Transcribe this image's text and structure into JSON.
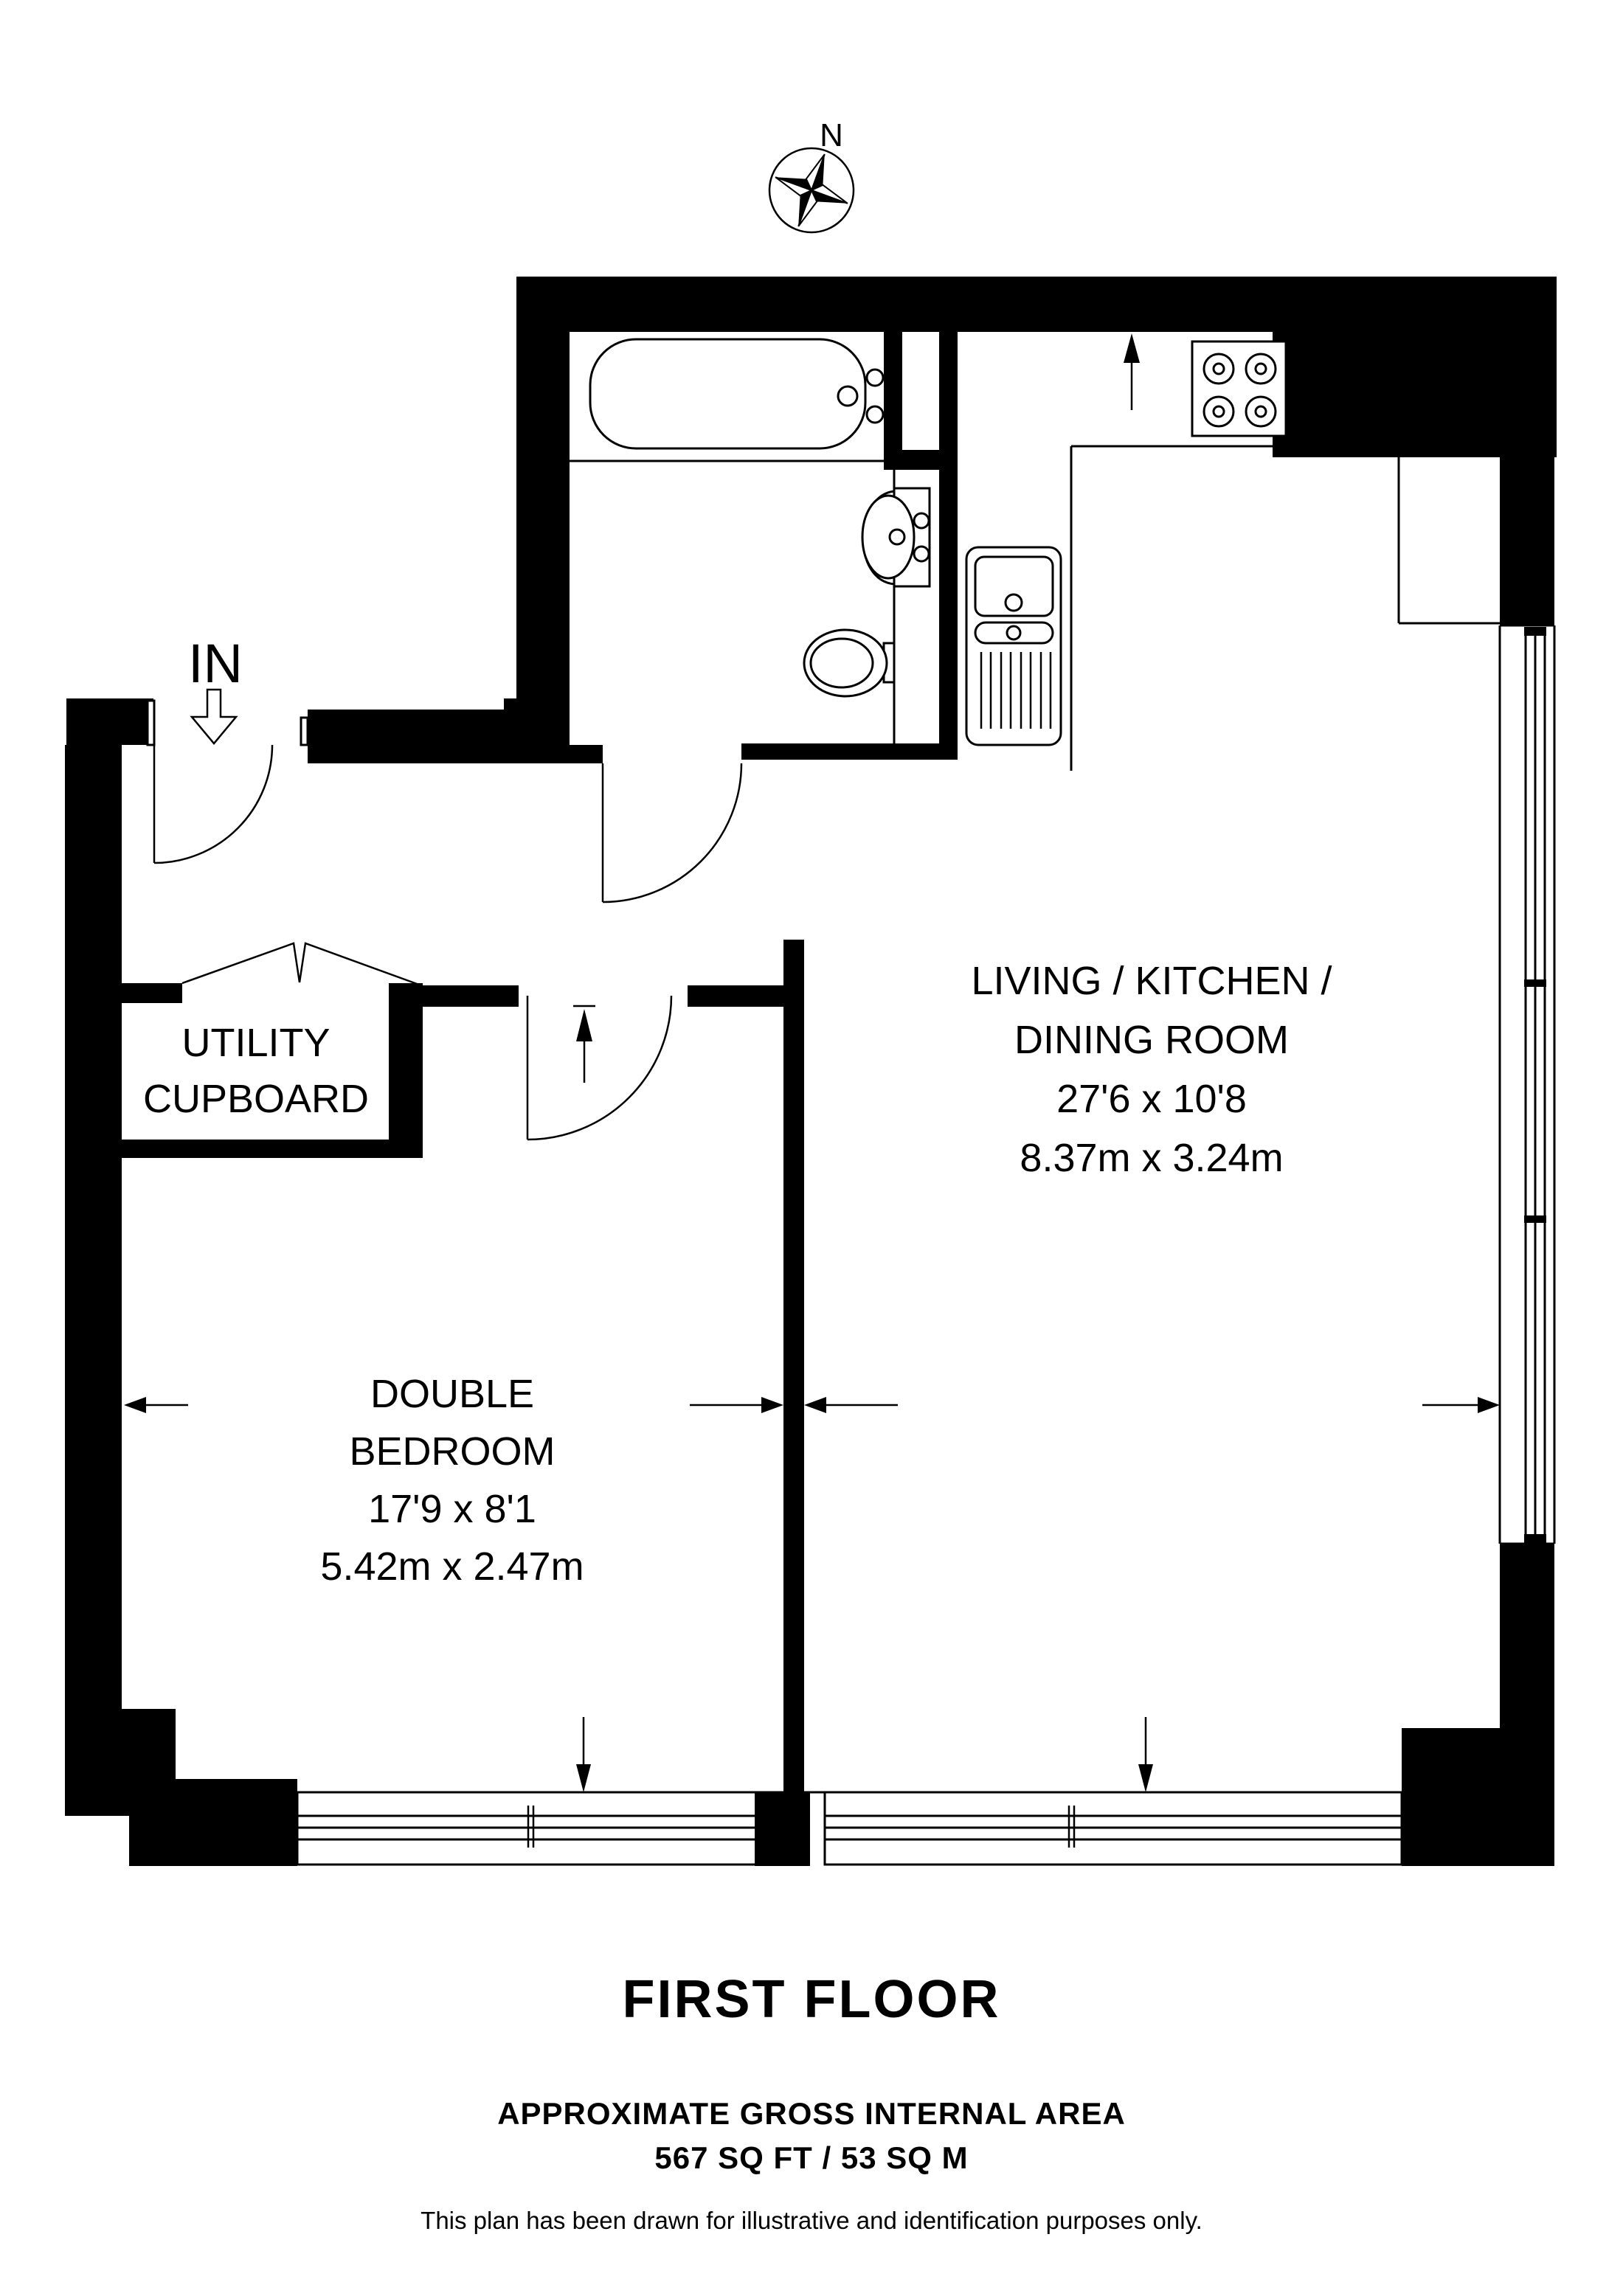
{
  "title": "First floor plan",
  "colors": {
    "line": "#000000",
    "background": "#ffffff"
  },
  "compass": {
    "label": "N"
  },
  "entrance": {
    "label": "IN"
  },
  "fixtures": [
    "compass-rose",
    "bathtub",
    "wash-basin",
    "toilet",
    "kitchen-sink",
    "hob",
    "entry-door",
    "bathroom-door",
    "bedroom-door",
    "bifold-doors",
    "windows"
  ],
  "rooms": {
    "utility": {
      "line1": "UTILITY",
      "line2": "CUPBOARD"
    },
    "bedroom": {
      "name_line1": "DOUBLE",
      "name_line2": "BEDROOM",
      "dims_imperial": "17'9 x 8'1",
      "dims_metric": "5.42m x 2.47m"
    },
    "living": {
      "name_line1": "LIVING / KITCHEN /",
      "name_line2": "DINING ROOM",
      "dims_imperial": "27'6 x 10'8",
      "dims_metric": "8.37m x 3.24m"
    }
  },
  "footer": {
    "floor_label": "FIRST FLOOR",
    "area_heading": "APPROXIMATE GROSS INTERNAL AREA",
    "area_value": "567 SQ FT / 53 SQ M",
    "disclaimer": "This plan has been drawn for illustrative and identification purposes only."
  }
}
